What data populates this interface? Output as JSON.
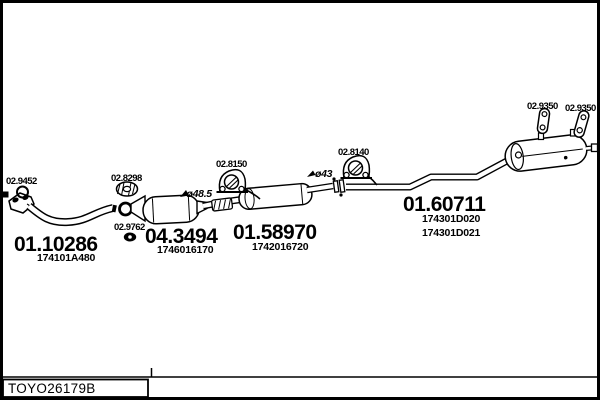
{
  "footer": {
    "drawing_code": "TOYO26179B"
  },
  "parts": {
    "front_pipe": {
      "code": "01.10286",
      "oem": "174101A480"
    },
    "catalyst": {
      "code": "04.3494",
      "oem": "1746016170"
    },
    "centre_silencer": {
      "code": "01.58970",
      "oem": "1742016720"
    },
    "rear_silencer": {
      "code": "01.60711",
      "oem1": "174301D020",
      "oem2": "174301D021"
    }
  },
  "fittings": {
    "ring_gasket": {
      "code": "02.9452",
      "icon": "ring-gasket-icon"
    },
    "clamp": {
      "code": "02.8298",
      "icon": "clamp-icon"
    },
    "flange_gasket": {
      "code": "02.9762",
      "icon": "oval-gasket-icon"
    },
    "rubber_hanger_mid": {
      "code": "02.8150",
      "icon": "rubber-hanger-icon"
    },
    "rubber_hanger_rear": {
      "code": "02.8140",
      "icon": "rubber-hanger-icon"
    },
    "hanger_rod_left": {
      "code": "02.9350",
      "icon": "hanger-rod-icon"
    },
    "hanger_rod_right": {
      "code": "02.9350",
      "icon": "hanger-rod-icon"
    }
  },
  "dimensions": {
    "cat_outlet_diameter": "ø48.5",
    "tail_pipe_diameter": "ø43"
  },
  "colors": {
    "line": "#000000",
    "background": "#ffffff"
  }
}
